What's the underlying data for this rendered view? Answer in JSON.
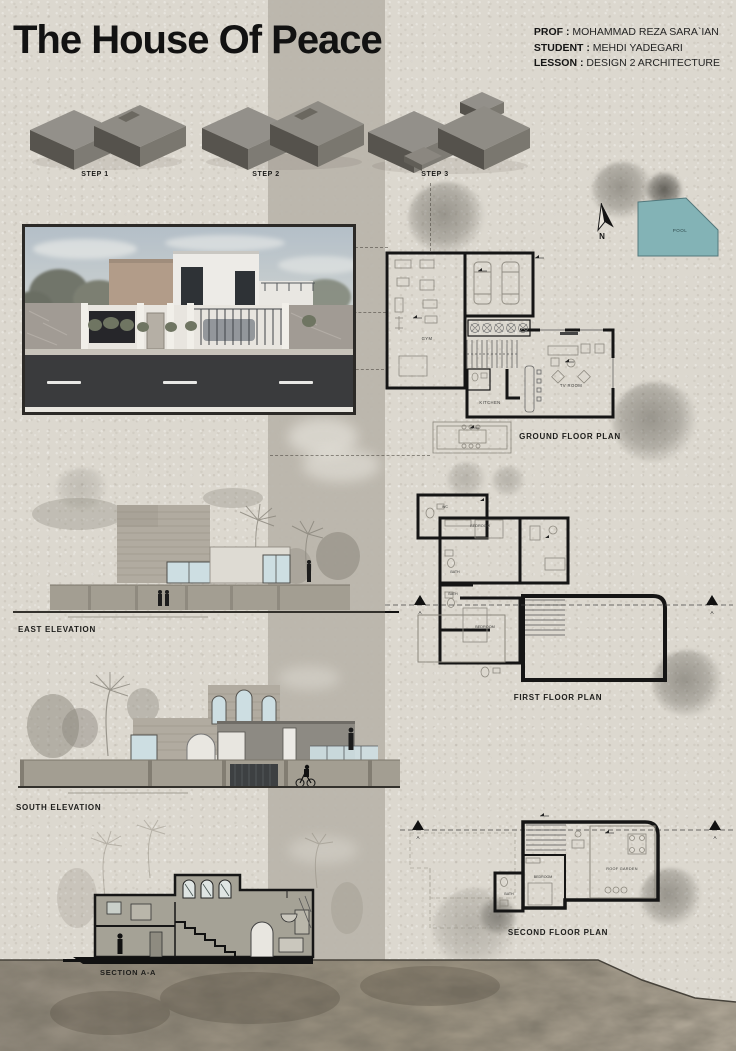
{
  "header": {
    "title": "The House Of Peace",
    "info": [
      {
        "label": "PROF :",
        "value": "MOHAMMAD REZA SARA`IAN"
      },
      {
        "label": "STUDENT :",
        "value": "MEHDI YADEGARI"
      },
      {
        "label": "LESSON :",
        "value": "DESIGN 2 ARCHITECTURE"
      }
    ]
  },
  "steps": [
    {
      "label": "STEP 1"
    },
    {
      "label": "STEP 2"
    },
    {
      "label": "STEP 3"
    }
  ],
  "site": {
    "pool_label": "POOL",
    "north_label": "N",
    "section_marker": "A"
  },
  "plans": {
    "ground": {
      "label": "GROUND FLOOR PLAN",
      "rooms": {
        "gym": "GYM",
        "kitchen": "KITCHEN",
        "tv_room": "TV ROOM"
      }
    },
    "first": {
      "label": "FIRST FLOOR PLAN",
      "rooms": {
        "bedroom_a": "BEDROOM",
        "bedroom_b": "BEDROOM",
        "bath_a": "BATH",
        "bath_b": "BATH",
        "wc": "WC"
      }
    },
    "second": {
      "label": "SECOND FLOOR PLAN",
      "rooms": {
        "bedroom": "BEDROOM",
        "bath": "BATH",
        "roof_garden": "ROOF GARDEN"
      }
    }
  },
  "elevations": {
    "east": {
      "label": "EAST ELEVATION"
    },
    "south": {
      "label": "SOUTH ELEVATION"
    }
  },
  "section": {
    "label": "SECTION A-A"
  },
  "palette": {
    "paper": "#dcd8cf",
    "band": "#b8b4aa",
    "ink": "#1c1c1a",
    "plan_wall": "#151515",
    "pool": "#83b3b6",
    "window_glass": "#cddee2",
    "massing_top": "#93908a",
    "massing_side": "#57544e",
    "terrain": "#8f887c"
  }
}
